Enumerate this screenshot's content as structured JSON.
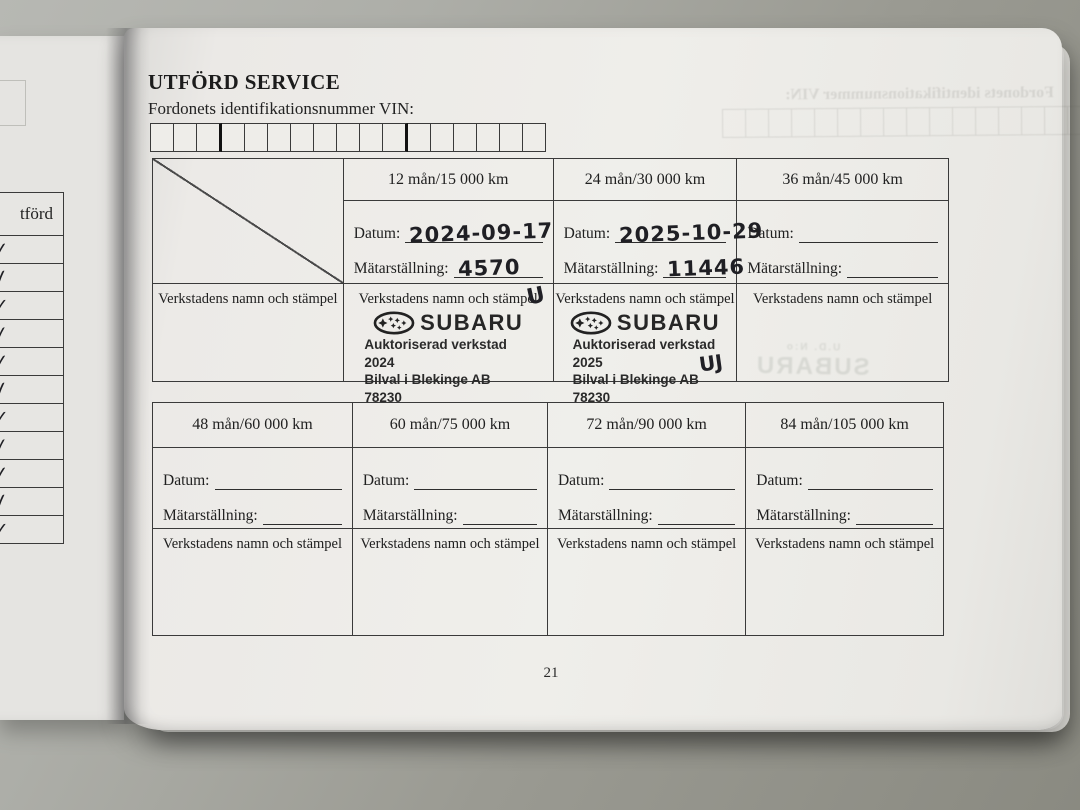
{
  "page": {
    "title": "UTFÖRD SERVICE",
    "vin_label": "Fordonets identifikationsnummer VIN:",
    "vin_cells": 17,
    "vin_thick_after": [
      3,
      11
    ],
    "page_number": "21"
  },
  "labels": {
    "datum": "Datum:",
    "odometer": "Mätarställning:",
    "workshop": "Verkstadens namn och stämpel"
  },
  "stamp": {
    "brand": "SUBARU",
    "company": "Bilval i Blekinge AB",
    "postcode": "78230"
  },
  "service_table_1": {
    "columns": [
      {
        "header": "",
        "type": "diagonal"
      },
      {
        "header": "12 mån/15 000 km",
        "datum": "2024-09-17",
        "odometer": "4570",
        "stamp_line1": "Auktoriserad verkstad 2024",
        "signature": "U"
      },
      {
        "header": "24 mån/30 000 km",
        "datum": "2025-10-29",
        "odometer": "11446",
        "stamp_line1": "Auktoriserad verkstad 2025",
        "signature": "UJ"
      },
      {
        "header": "36 mån/45 000 km",
        "datum": "",
        "odometer": ""
      }
    ]
  },
  "service_table_2": {
    "columns": [
      {
        "header": "48 mån/60 000 km",
        "datum": "",
        "odometer": ""
      },
      {
        "header": "60 mån/75 000 km",
        "datum": "",
        "odometer": ""
      },
      {
        "header": "72 mån/90 000 km",
        "datum": "",
        "odometer": ""
      },
      {
        "header": "84 mån/105 000 km",
        "datum": "",
        "odometer": ""
      }
    ]
  },
  "left_page": {
    "column_header": "tförd",
    "checks": [
      "✓",
      "✓",
      "✓",
      "✓",
      "✓",
      "✓",
      "✓",
      "✓",
      "✓",
      "✓",
      "✓"
    ]
  },
  "ghost": {
    "vin_label": "Fordonets identifikationsnummer VIN:",
    "brand": "SUBARU",
    "small": "U.D.  N:o"
  }
}
